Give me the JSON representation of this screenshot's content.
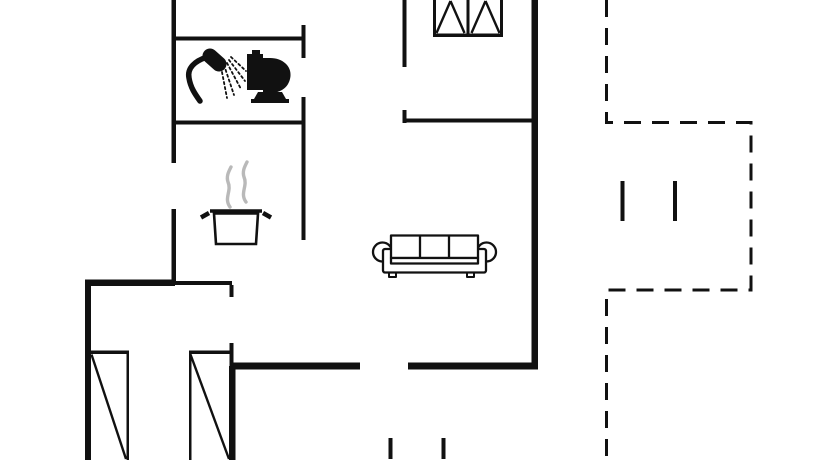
{
  "canvas": {
    "width": 834,
    "height": 460,
    "background": "#ffffff",
    "wall_color": "#111111",
    "steam_color": "#b9b9b9",
    "thin_stroke": 2.4,
    "dash_pattern": "17,11"
  },
  "floorplan": {
    "walls": [
      [
        171.5,
        0,
        4.5,
        163
      ],
      [
        171.5,
        209,
        4.5,
        75
      ],
      [
        173,
        36.5,
        131,
        4
      ],
      [
        301.5,
        25,
        4,
        33
      ],
      [
        173,
        120.5,
        131,
        4
      ],
      [
        301.5,
        97,
        4,
        143
      ],
      [
        402.5,
        0,
        4,
        67
      ],
      [
        402.5,
        110,
        4,
        13
      ],
      [
        404,
        118.5,
        128,
        4
      ],
      [
        85,
        279.5,
        90,
        6.5
      ],
      [
        175,
        281,
        57,
        4
      ],
      [
        229.5,
        285,
        4,
        12
      ],
      [
        229.5,
        343,
        4,
        25
      ],
      [
        85,
        279.5,
        6,
        180.5
      ],
      [
        229,
        366,
        6.5,
        94
      ],
      [
        232,
        362.5,
        128,
        7
      ],
      [
        408,
        362.5,
        130,
        7
      ],
      [
        531.5,
        0,
        6.5,
        369.5
      ]
    ],
    "window": {
      "x": 433,
      "y": 0,
      "w": 70,
      "h": 37,
      "frame": 3,
      "sill": 3.5
    },
    "wardrobes": [
      {
        "x": 90,
        "y": 350.5,
        "w": 39,
        "h": 109.5,
        "edge": "right"
      },
      {
        "x": 189,
        "y": 350.5,
        "w": 43,
        "h": 109.5,
        "edge": "left"
      }
    ],
    "terrace_outline": [
      [
        606.5,
        0
      ],
      [
        606.5,
        122.5
      ],
      [
        751,
        122.5
      ],
      [
        751,
        290
      ],
      [
        606.5,
        290
      ],
      [
        606.5,
        460
      ]
    ],
    "step_marks": [
      [
        620.5,
        181,
        4,
        40
      ],
      [
        673,
        181,
        4,
        40
      ],
      [
        388.5,
        438,
        4,
        21
      ],
      [
        441.5,
        438,
        4,
        21
      ]
    ],
    "furniture": {
      "shower": {
        "name": "shower-icon",
        "x": 184,
        "y": 48
      },
      "toilet": {
        "name": "toilet-icon",
        "x": 243,
        "y": 49
      },
      "pot": {
        "name": "cooking-pot-icon",
        "x": 198,
        "y": 160
      },
      "sofa": {
        "name": "sofa-icon",
        "x": 372,
        "y": 233
      }
    }
  }
}
